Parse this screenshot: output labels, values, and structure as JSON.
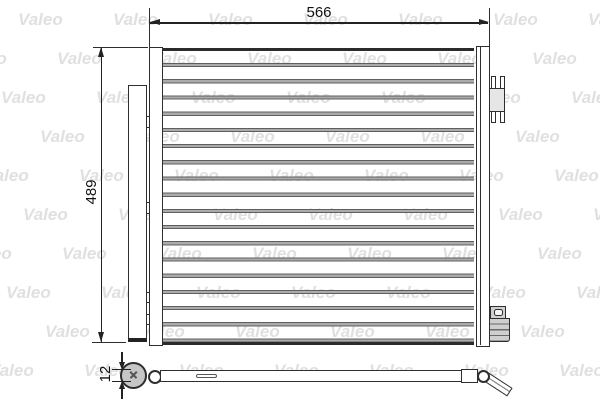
{
  "diagram": {
    "brand_watermark": "Valeo",
    "watermark_color": "#e0e0e0",
    "line_color": "#2e2e2e",
    "dimensions": {
      "width_label": "566",
      "height_label": "489",
      "pipe_diameter_label": "12"
    }
  }
}
